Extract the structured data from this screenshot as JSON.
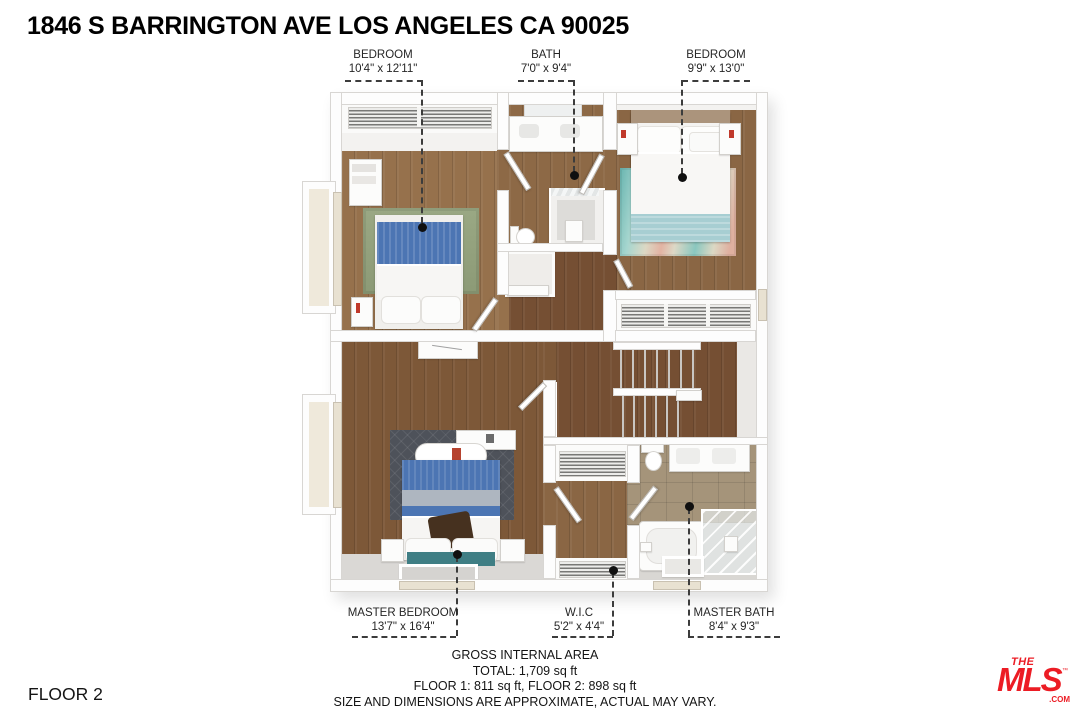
{
  "title": "1846 S BARRINGTON AVE LOS ANGELES CA 90025",
  "floor_label": "FLOOR 2",
  "room_labels": [
    {
      "name": "BEDROOM",
      "dims": "10'4\" x 12'11\""
    },
    {
      "name": "BATH",
      "dims": "7'0\" x 9'4\""
    },
    {
      "name": "BEDROOM",
      "dims": "9'9\" x 13'0\""
    },
    {
      "name": "MASTER BEDROOM",
      "dims": "13'7\" x 16'4\""
    },
    {
      "name": "W.I.C",
      "dims": "5'2\" x 4'4\""
    },
    {
      "name": "MASTER BATH",
      "dims": "8'4\" x 9'3\""
    }
  ],
  "footer": {
    "line1": "GROSS INTERNAL AREA",
    "line2": "TOTAL: 1,709 sq ft",
    "line3": "FLOOR 1: 811 sq ft, FLOOR 2: 898 sq ft",
    "line4": "SIZE AND DIMENSIONS ARE APPROXIMATE, ACTUAL MAY VARY."
  },
  "logo": {
    "the": "THE",
    "mls": "MLS",
    "tm": "™",
    "com": ".COM"
  },
  "colors": {
    "brand_red": "#EC1C24",
    "wall": "#FDFDFD",
    "wood_light": "#96714C",
    "wood_mid": "#8A6644",
    "wood_dark": "#754F33",
    "rug_green": "#93A17C",
    "rug_dark": "#4E525A",
    "blanket_blue": "#4C75B3",
    "blanket_teal": "#A7CED2",
    "tile_tan": "#A5947A",
    "text": "#141414"
  }
}
